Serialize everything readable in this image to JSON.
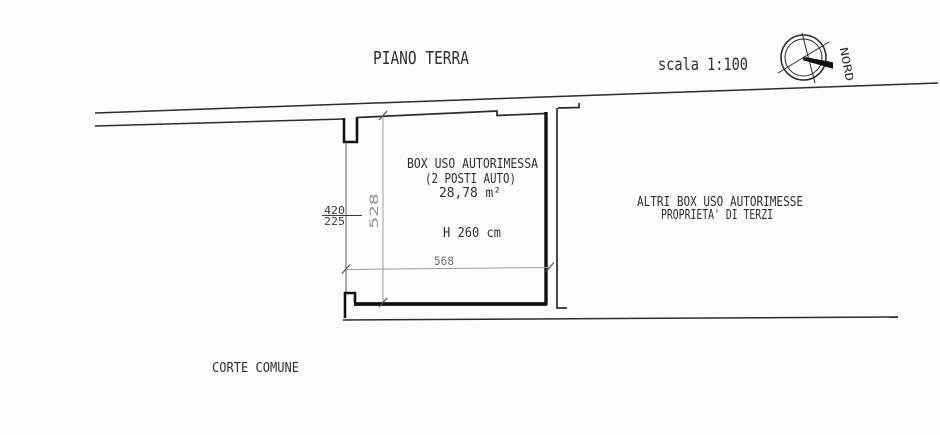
{
  "title": "PIANO TERRA",
  "scale_label": "scala 1:100",
  "compass": {
    "north_label": "NORD"
  },
  "room": {
    "name_line1": "BOX USO AUTORIMESSA",
    "name_line2": "(2 POSTI AUTO)",
    "area": "28,78 m²",
    "ceiling_height": "H 260 cm"
  },
  "neighbor": {
    "line1": "ALTRI BOX USO AUTORIMESSE",
    "line2": "PROPRIETA' DI TERZI"
  },
  "courtyard_label": "CORTE COMUNE",
  "dimensions": {
    "room_width": "568",
    "room_depth": "528",
    "door_opening_width": "420",
    "door_opening_height": "225"
  },
  "colors": {
    "background": "#fdfdfd",
    "line": "#2b2b2b",
    "wall": "#111111",
    "dim": "#9a9a9a",
    "text": "#2f2f2f",
    "dim_text": "#8f8f8f"
  }
}
